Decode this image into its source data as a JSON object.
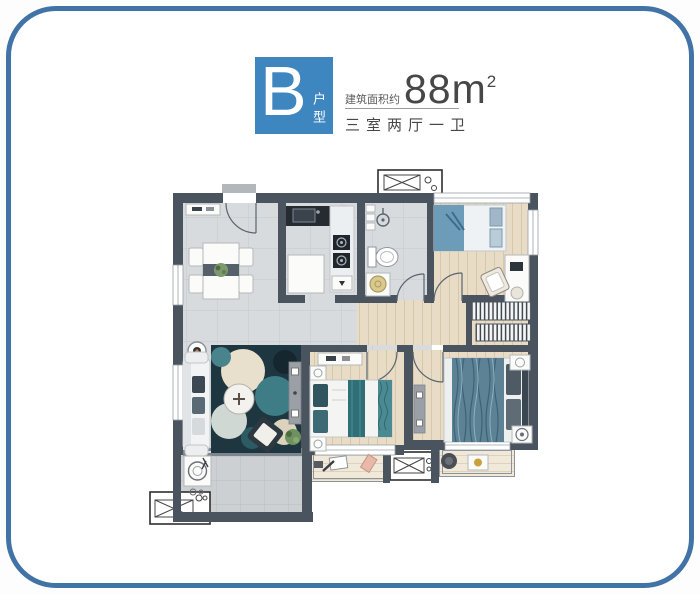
{
  "header": {
    "unit_letter": "B",
    "unit_type_vertical": "户型",
    "area_prefix": "建筑面积约",
    "area_value": "88m",
    "area_superscript": "2",
    "layout_text": "三室两厅一卫"
  },
  "colors": {
    "frame_border": "#4173a6",
    "accent_blue": "#3d86c0",
    "text_dark": "#474747",
    "wall": "#4a545e",
    "tile_floor": "#d8dbde",
    "tile_dark": "#ccd0d3",
    "wood_floor": "#e8dcc6",
    "balcony_floor": "#f0e9da",
    "rug_dark": "#1d3640",
    "bed_blue": "#6e93a6",
    "teal": "#39757e",
    "gold": "#c8a23c"
  }
}
